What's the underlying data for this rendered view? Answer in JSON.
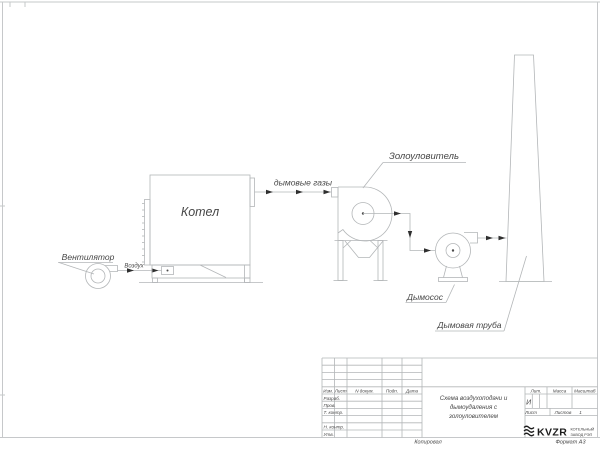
{
  "colors": {
    "line": "#b3b6b8",
    "frame": "#c6c8ca",
    "text": "#474747",
    "arrow": "#2f2f2f",
    "logo": "#1c1c1c"
  },
  "drawing": {
    "fan_label": "Вентилятор",
    "air_label": "Воздух",
    "boiler_label": "Котел",
    "flue_gas_label": "дымовые газы",
    "ash_collector_label": "Золоуловитель",
    "smoke_exhauster_label": "Дымосос",
    "chimney_label": "Дымовая труба"
  },
  "title_block": {
    "change_header": {
      "izm": "Изм.",
      "list": "Лист",
      "doc": "N докум.",
      "sign": "Подп.",
      "date": "Дата"
    },
    "signature_rows": [
      "Разраб.",
      "Пров.",
      "Т. контр.",
      "Н. контр.",
      "Утв."
    ],
    "doc_title_lines": [
      "Схема воздухоподачи и",
      "дымоудаления с",
      "золоуловителем"
    ],
    "lit_header": "Лит.",
    "lit_value": "И",
    "mass_header": "Масса",
    "scale_header": "Масштаб",
    "sheet_label": "Лист",
    "sheets_label": "Листов",
    "sheets_value": "1",
    "logo_text": "KVZR",
    "org_lines": [
      "КОТЕЛЬНЫЙ",
      "ЗАВОД РЭП"
    ]
  },
  "margins": {
    "copied": "Копировал",
    "format": "Формат А3"
  }
}
